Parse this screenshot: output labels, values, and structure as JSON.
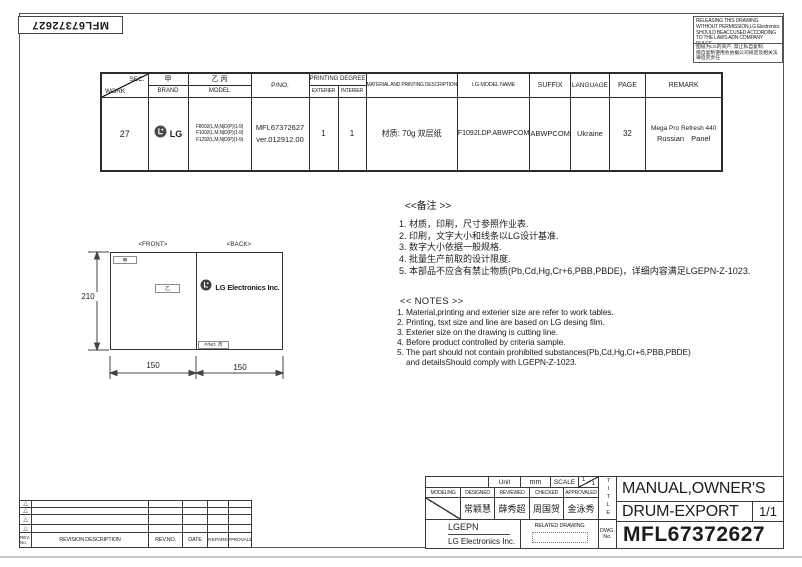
{
  "corner": {
    "part_number": "MFL67372627"
  },
  "warning_box": {
    "line_en": "RELEASING THIS DRAWING WITHOUT PERMISSION,LG Electronics SHOULD BEACCUSED ACCORDING TO THE LAWS ADN COMPANY RULES.",
    "line_cn_1": "图纸为LG的资产, 禁止私自复制.",
    "line_cn_2": "擅自复制使用会依据公司规定及相关法律追究责任"
  },
  "spec_table": {
    "diag": {
      "top": "SEC.",
      "bottom": "WORK"
    },
    "h1": {
      "jia": "甲",
      "yi_bing": "乙 丙",
      "printing_degree": "PRINTING DEGREE",
      "material": "MATERIAL AND PRINTING DESCRIPTION",
      "lg_model_name": "LG MODEL NAME",
      "suffix": "SUFFIX",
      "language": "LANGUAGE",
      "page": "PAGE",
      "remark": "REMARK",
      "pno": "P/NO."
    },
    "h2": {
      "brand": "BRAND",
      "model": "MODEL",
      "exterier": "EXTERIER",
      "interier": "INTERIER"
    },
    "row": {
      "work": "27",
      "brand_text": "LG",
      "models": [
        "F8092(L,M,N|D(P)(1-9)",
        "F1092(L,M,N|D(P)(1-9)",
        "F1292(L,M,N|D(P)(1-9)"
      ],
      "pno_lines": [
        "MFL67372627",
        "ver.012912.00"
      ],
      "exterier": "1",
      "interier": "1",
      "material": "材质: 70g 双层纸",
      "lg_model_name": "F1092LDP.ABWPCOM",
      "suffix": "ABWPCOM",
      "language": "Ukraine",
      "page": "32",
      "remark_lines": [
        "Mega Pro Refresh  440",
        "Russian Panel"
      ]
    }
  },
  "drawing": {
    "front_label": "<FRONT>",
    "back_label": "<BACK>",
    "jia": "甲",
    "yi": "乙",
    "pno_box": "P/NO. 丙",
    "logo_text": "LG Electronics Inc.",
    "dim_height": "210",
    "dim_width_left": "150",
    "dim_width_right": "150"
  },
  "notes_cn": {
    "title": "<<备注 >>",
    "items": [
      "1.  材质，印刷，尺寸参照作业表.",
      "2.  印刷，文字大小和线条以LG设计基准.",
      "3.  数字大小依据一般规格.",
      "4.  批量生产前取的设计限度.",
      "5.  本部品不应含有禁止物质(Pb,Cd,Hg,Cr+6,PBB,PBDE)，详细内容满足LGEPN-Z-1023."
    ]
  },
  "notes_en": {
    "title": "<< NOTES >>",
    "items": [
      "1. Material,printing and exterier size are refer to work tables.",
      "2. Printing, tsxt  size and line are based on LG desing film.",
      "3. Exterier size on the drawing is cutting line.",
      "4. Before product controlled by criteria sample.",
      "5. The part should not contain prohibited substances(Pb,Cd,Hg,Cr+6,PBB,PBDE)",
      "and detailsShould comply with LGEPN-Z-1023."
    ]
  },
  "title_block": {
    "unit_label": "Unit",
    "unit_value": "mm",
    "scale_label": "SCALE",
    "scale_num": "1",
    "scale_den": "1",
    "roles": [
      "MODELING",
      "DESIGNED",
      "REVIEWED",
      "CHECKED",
      "APPROVALED"
    ],
    "signatures": [
      "常颖慧",
      "薛秀超",
      "周国贺",
      "金泳秀"
    ],
    "company_code": "LGEPN",
    "company_name": "LG Electronics Inc.",
    "related_drawing": "RELATED DRAWING",
    "title_vertical": "TITLE",
    "dwg_label_1": "DWG,",
    "dwg_label_2": "No.",
    "title_line1": "MANUAL,OWNER'S",
    "title_line2": "DRUM-EXPORT",
    "sheet": "1/1",
    "drawing_number": "MFL67372627"
  },
  "revision_table": {
    "marker": "△",
    "headers": {
      "rev_marker": "REV. No.",
      "description": "REVISION DESCRIPTION",
      "rev_no": "REV.NO.",
      "date": "DATE",
      "prepared": "PREPARED",
      "approved": "APPROVALED"
    }
  },
  "colors": {
    "line": "#3a3a3a",
    "logo": "#4a4a4a",
    "page_edge": "#c9c9c9"
  }
}
